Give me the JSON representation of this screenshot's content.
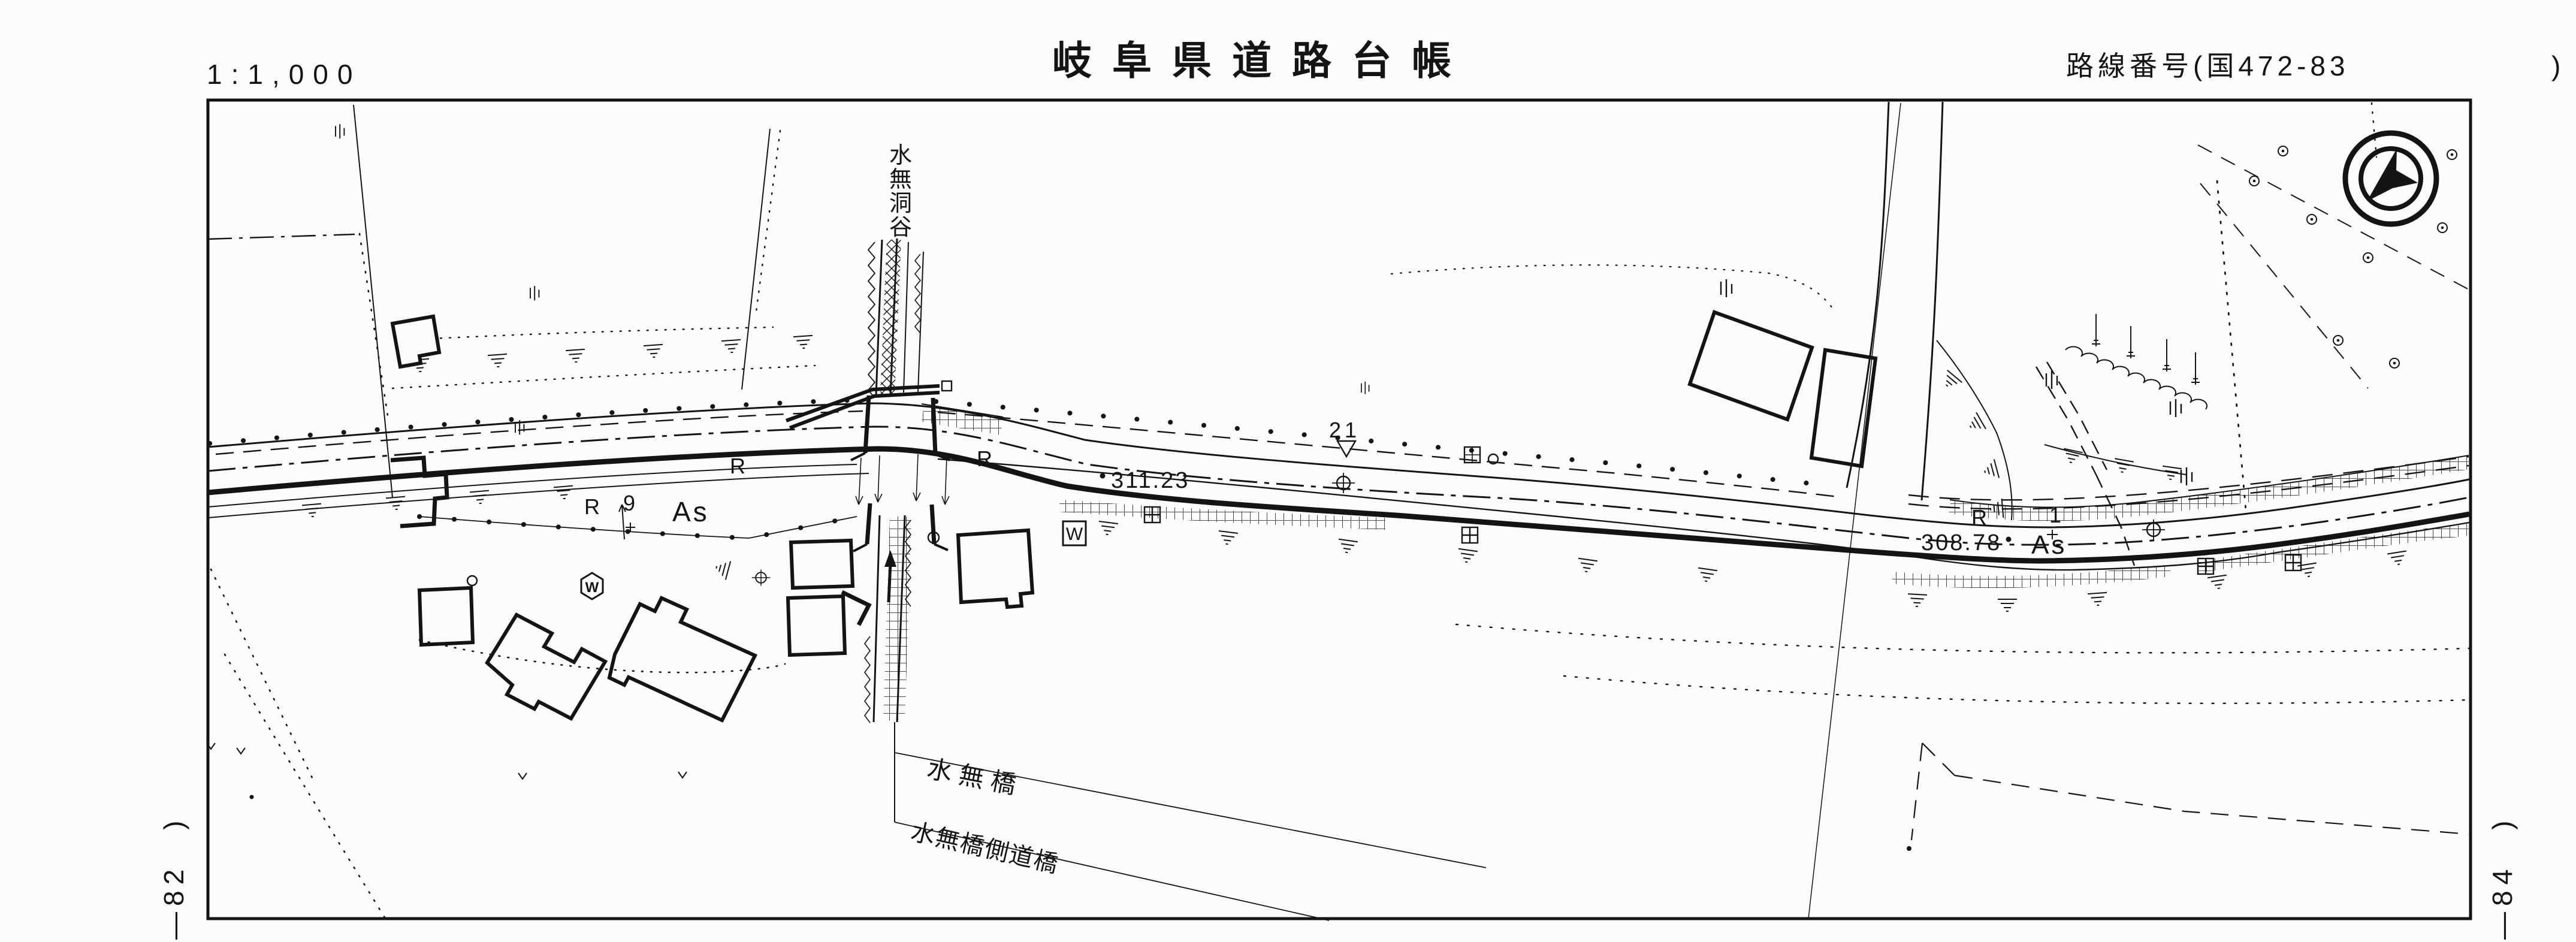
{
  "colors": {
    "paper": "#fcfcfa",
    "ink": "#141414"
  },
  "header": {
    "scale_label": "1:1,000",
    "title": "岐阜県道路台帳",
    "route_main": "路線番号(国472-83",
    "route_paren": ")"
  },
  "sheet_refs": {
    "left": "—82　)",
    "right": "—84　)"
  },
  "icons": {
    "north_indicator": "circled-north-arrow"
  },
  "map": {
    "stream_chars": [
      "水",
      "無",
      "洞",
      "谷"
    ],
    "bridge_label": "水無橋",
    "side_bridge_label": "水無橋側道橋",
    "elevations": [
      "311.23",
      "308.78"
    ],
    "surface_labels": [
      "As",
      "As"
    ],
    "r_marks": [
      "R",
      "R",
      "R",
      "R"
    ],
    "station_numbers": [
      "9",
      "1"
    ],
    "km_post": "21",
    "water_labels": [
      "W",
      "W"
    ]
  }
}
